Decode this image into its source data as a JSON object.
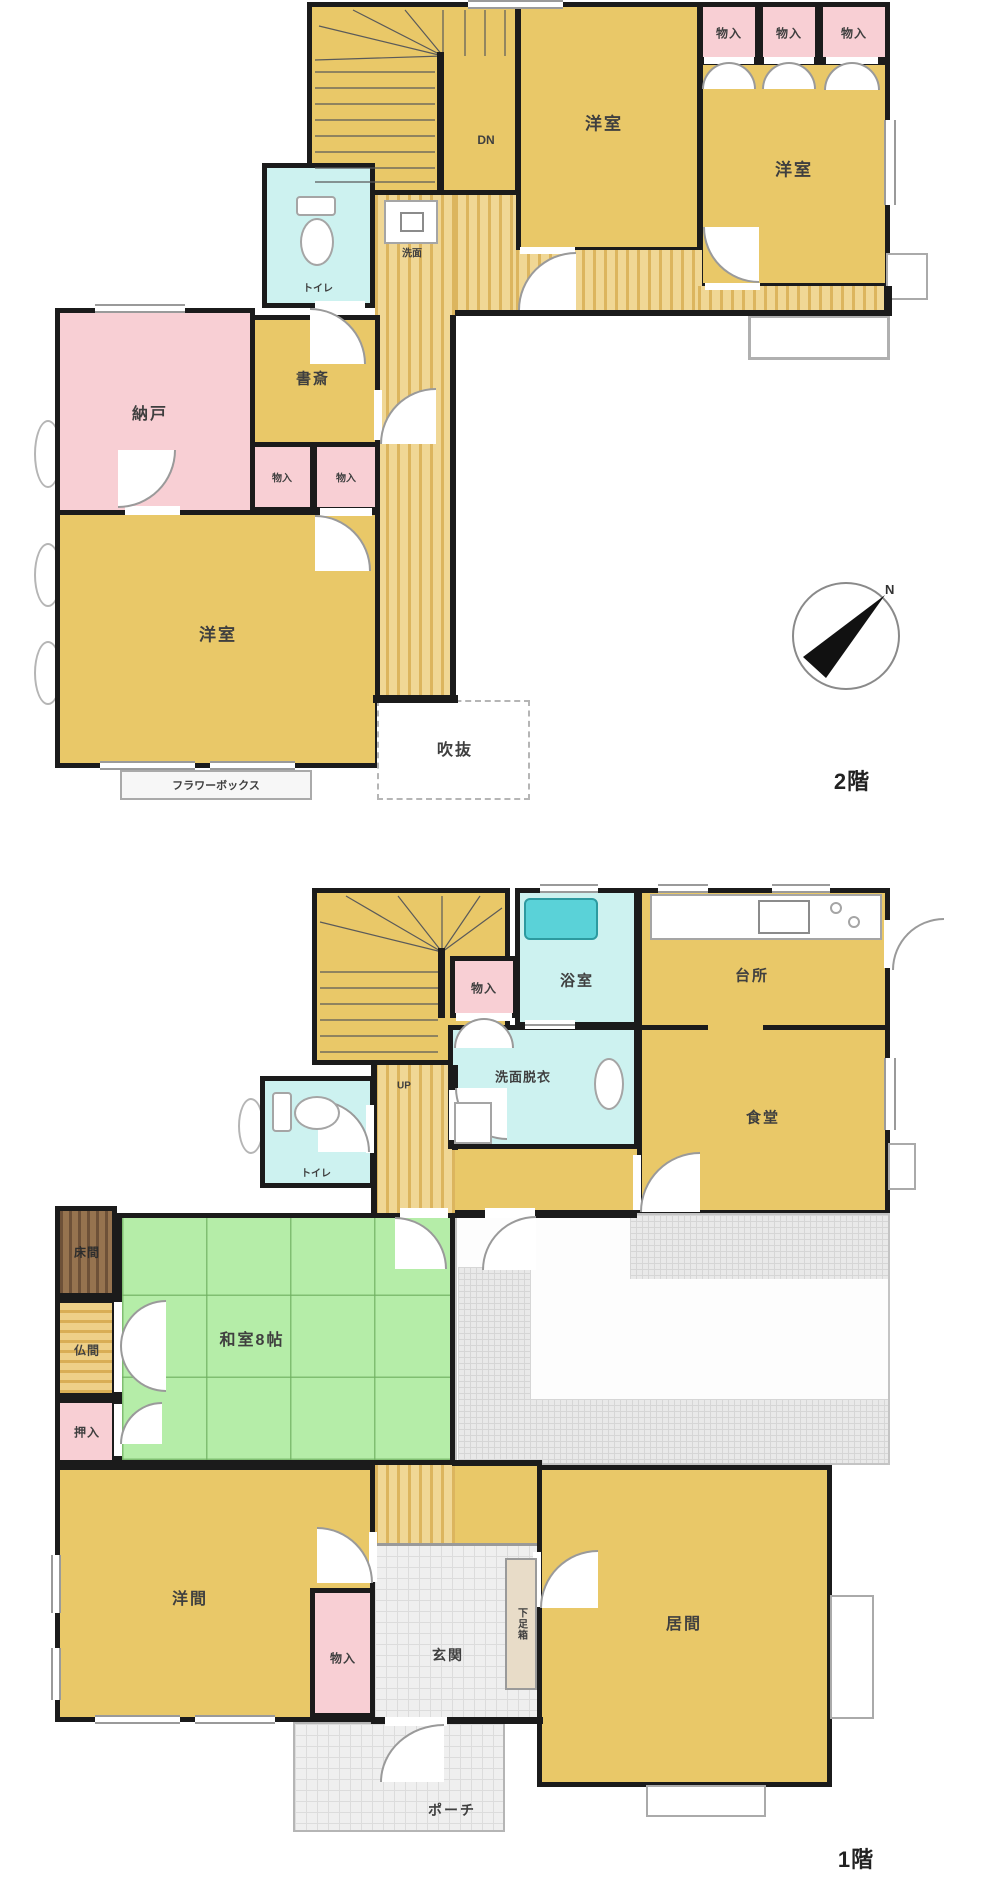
{
  "floor2": {
    "title": "2階",
    "rooms": {
      "yoshitsu": "洋室",
      "nando": "納戸",
      "shosai": "書斎",
      "monoiri": "物入",
      "toilet": "トイレ",
      "senmen": "洗面",
      "fukinuke": "吹抜",
      "flower_box": "フラワーボックス",
      "stairs_dn": "DN"
    }
  },
  "floor1": {
    "title": "1階",
    "rooms": {
      "yokushitsu": "浴室",
      "daidokoro": "台所",
      "shokudo": "食堂",
      "senmen_datsui": "洗面脱衣",
      "monoiri": "物入",
      "toilet": "トイレ",
      "washitsu": "和室8帖",
      "tokonoma": "床間",
      "butsuma": "仏間",
      "oshiire": "押入",
      "yoma": "洋間",
      "ima": "居間",
      "genkan": "玄関",
      "getabako": "下足箱",
      "porch": "ポーチ",
      "stairs_up": "UP"
    }
  },
  "compass": {
    "north": "N"
  },
  "colors": {
    "room_yellow": "#e9c868",
    "closet_pink": "#f8cfd4",
    "wet_cyan": "#cdf2f0",
    "tatami_green": "#b5eda8",
    "wall": "#1b1b1b"
  }
}
